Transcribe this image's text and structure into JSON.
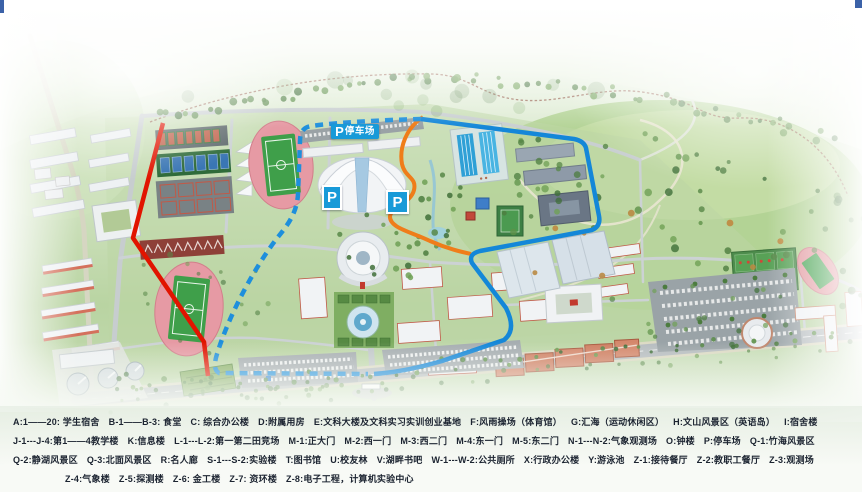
{
  "map": {
    "parking_banner": {
      "icon": "P",
      "label": "停车场"
    },
    "parking_signs": [
      "P",
      "P"
    ]
  },
  "legend": {
    "rows": [
      [
        "A:1——20: 学生宿舍",
        "B-1——B-3: 食堂",
        "C: 综合办公楼",
        "D:附属用房",
        "E:文科大楼及文科实习实训创业基地",
        "F:风雨操场（体育馆）",
        "G:汇海（运动休闲区）",
        "H:文山风景区（英语岛）",
        "I:宿舍楼"
      ],
      [
        "J-1---J-4:第1——4教学楼",
        "K:信息楼",
        "L-1---L-2:第一第二田竞场",
        "M-1:正大门",
        "M-2:西一门",
        "M-3:西二门",
        "M-4:东一门",
        "M-5:东二门",
        "N-1---N-2:气象观测场",
        "O:钟楼",
        "P:停车场",
        "Q-1:竹海风景区"
      ],
      [
        "Q-2:静湖风景区",
        "Q-3:北面风景区",
        "R:名人廊",
        "S-1---S-2:实验楼",
        "T:图书馆",
        "U:校友林",
        "V:湖畔书吧",
        "W-1---W-2:公共厕所",
        "X:行政办公楼",
        "Y:游泳池",
        "Z-1:接待餐厅",
        "Z-2:教职工餐厅",
        "Z-3:观测场"
      ],
      [
        "Z-4:气象楼",
        "Z-5:探测楼",
        "Z-6: 金工楼",
        "Z-7: 资环楼",
        "Z-8:电子工程，计算机实验中心"
      ]
    ]
  },
  "colors": {
    "route_red": "#e11400",
    "route_orange": "#ef7d1a",
    "route_blue_solid": "#1487d8",
    "route_blue_dashed": "#1e8fdc",
    "parking_blue": "#189ad8",
    "track_pink": "#e69aa4",
    "field_green": "#3f9f4a"
  }
}
